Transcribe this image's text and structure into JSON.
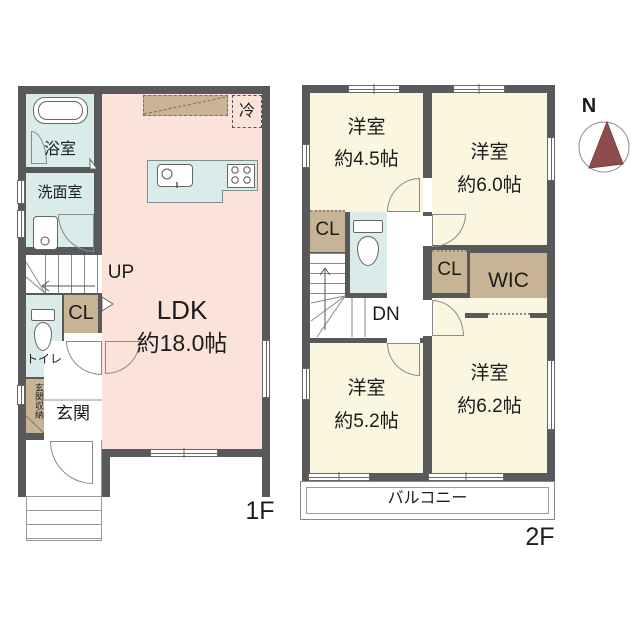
{
  "colors": {
    "wall": "#59585a",
    "ldk": "#fbe3da",
    "room": "#faf6df",
    "wet": "#d9ece9",
    "tan": "#c7b494",
    "needle": "#8e4c4c"
  },
  "floor1": {
    "floor_label": "1F",
    "ldk_name": "LDK",
    "ldk_size": "約18.0帖",
    "bath": "浴室",
    "washroom": "洗面室",
    "toilet": "トイレ",
    "entrance": "玄関",
    "entrance_storage": "玄関収納",
    "closet": "CL",
    "stairs": "UP",
    "fridge": "冷"
  },
  "floor2": {
    "floor_label": "2F",
    "room1": {
      "name": "洋室",
      "size": "約4.5帖"
    },
    "room2": {
      "name": "洋室",
      "size": "約6.0帖"
    },
    "room3": {
      "name": "洋室",
      "size": "約5.2帖"
    },
    "room4": {
      "name": "洋室",
      "size": "約6.2帖"
    },
    "closet1": "CL",
    "closet2": "CL",
    "wic": "WIC",
    "stairs": "DN",
    "balcony": "バルコニー"
  },
  "compass": {
    "north_label": "N"
  }
}
